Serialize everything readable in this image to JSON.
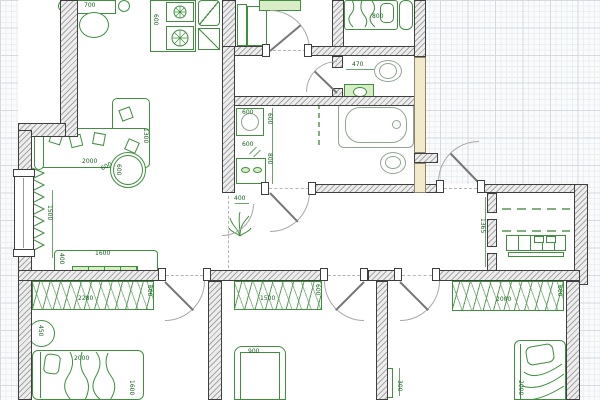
{
  "canvas": {
    "type": "floor-plan-drawing",
    "colors": {
      "grid_minor": "#eceff1",
      "grid_major": "#d7dbdf",
      "paper": "#fafbfc",
      "interior": "#ffffff",
      "wall_fill": "#ededed",
      "wall_outline": "#3e3e3e",
      "cream_wall": "#f3e9cb",
      "furniture": "#3f8f3f",
      "furniture_fill": "#d8ecc6",
      "dimension_text": "#17611f",
      "door": "#777777"
    }
  },
  "dims": {
    "dining_table": "700",
    "kitchen_unit": "600",
    "top_bed": "800",
    "wc_width": "470",
    "washer": "600",
    "bath_shelf": "600",
    "bath_side_a": "600",
    "bath_side_b": "800",
    "living_sofa_w": "2000",
    "living_sofa_d": "1300",
    "living_table": "600",
    "living_table_b": "600",
    "living_height": "1500",
    "tv_w": "1600",
    "tv_d": "400",
    "hall_pass": "400",
    "closet_depth": "1365",
    "wd1_w": "2280",
    "wd1_d": "600",
    "side_table": "450",
    "bed1_w": "2000",
    "bed1_l": "1600",
    "wd2_w": "1500",
    "wd2_d": "600",
    "bed2_w": "900",
    "mirror": "300",
    "wd3_w": "2000",
    "wd3_d": "600",
    "bed3_l": "2000"
  }
}
